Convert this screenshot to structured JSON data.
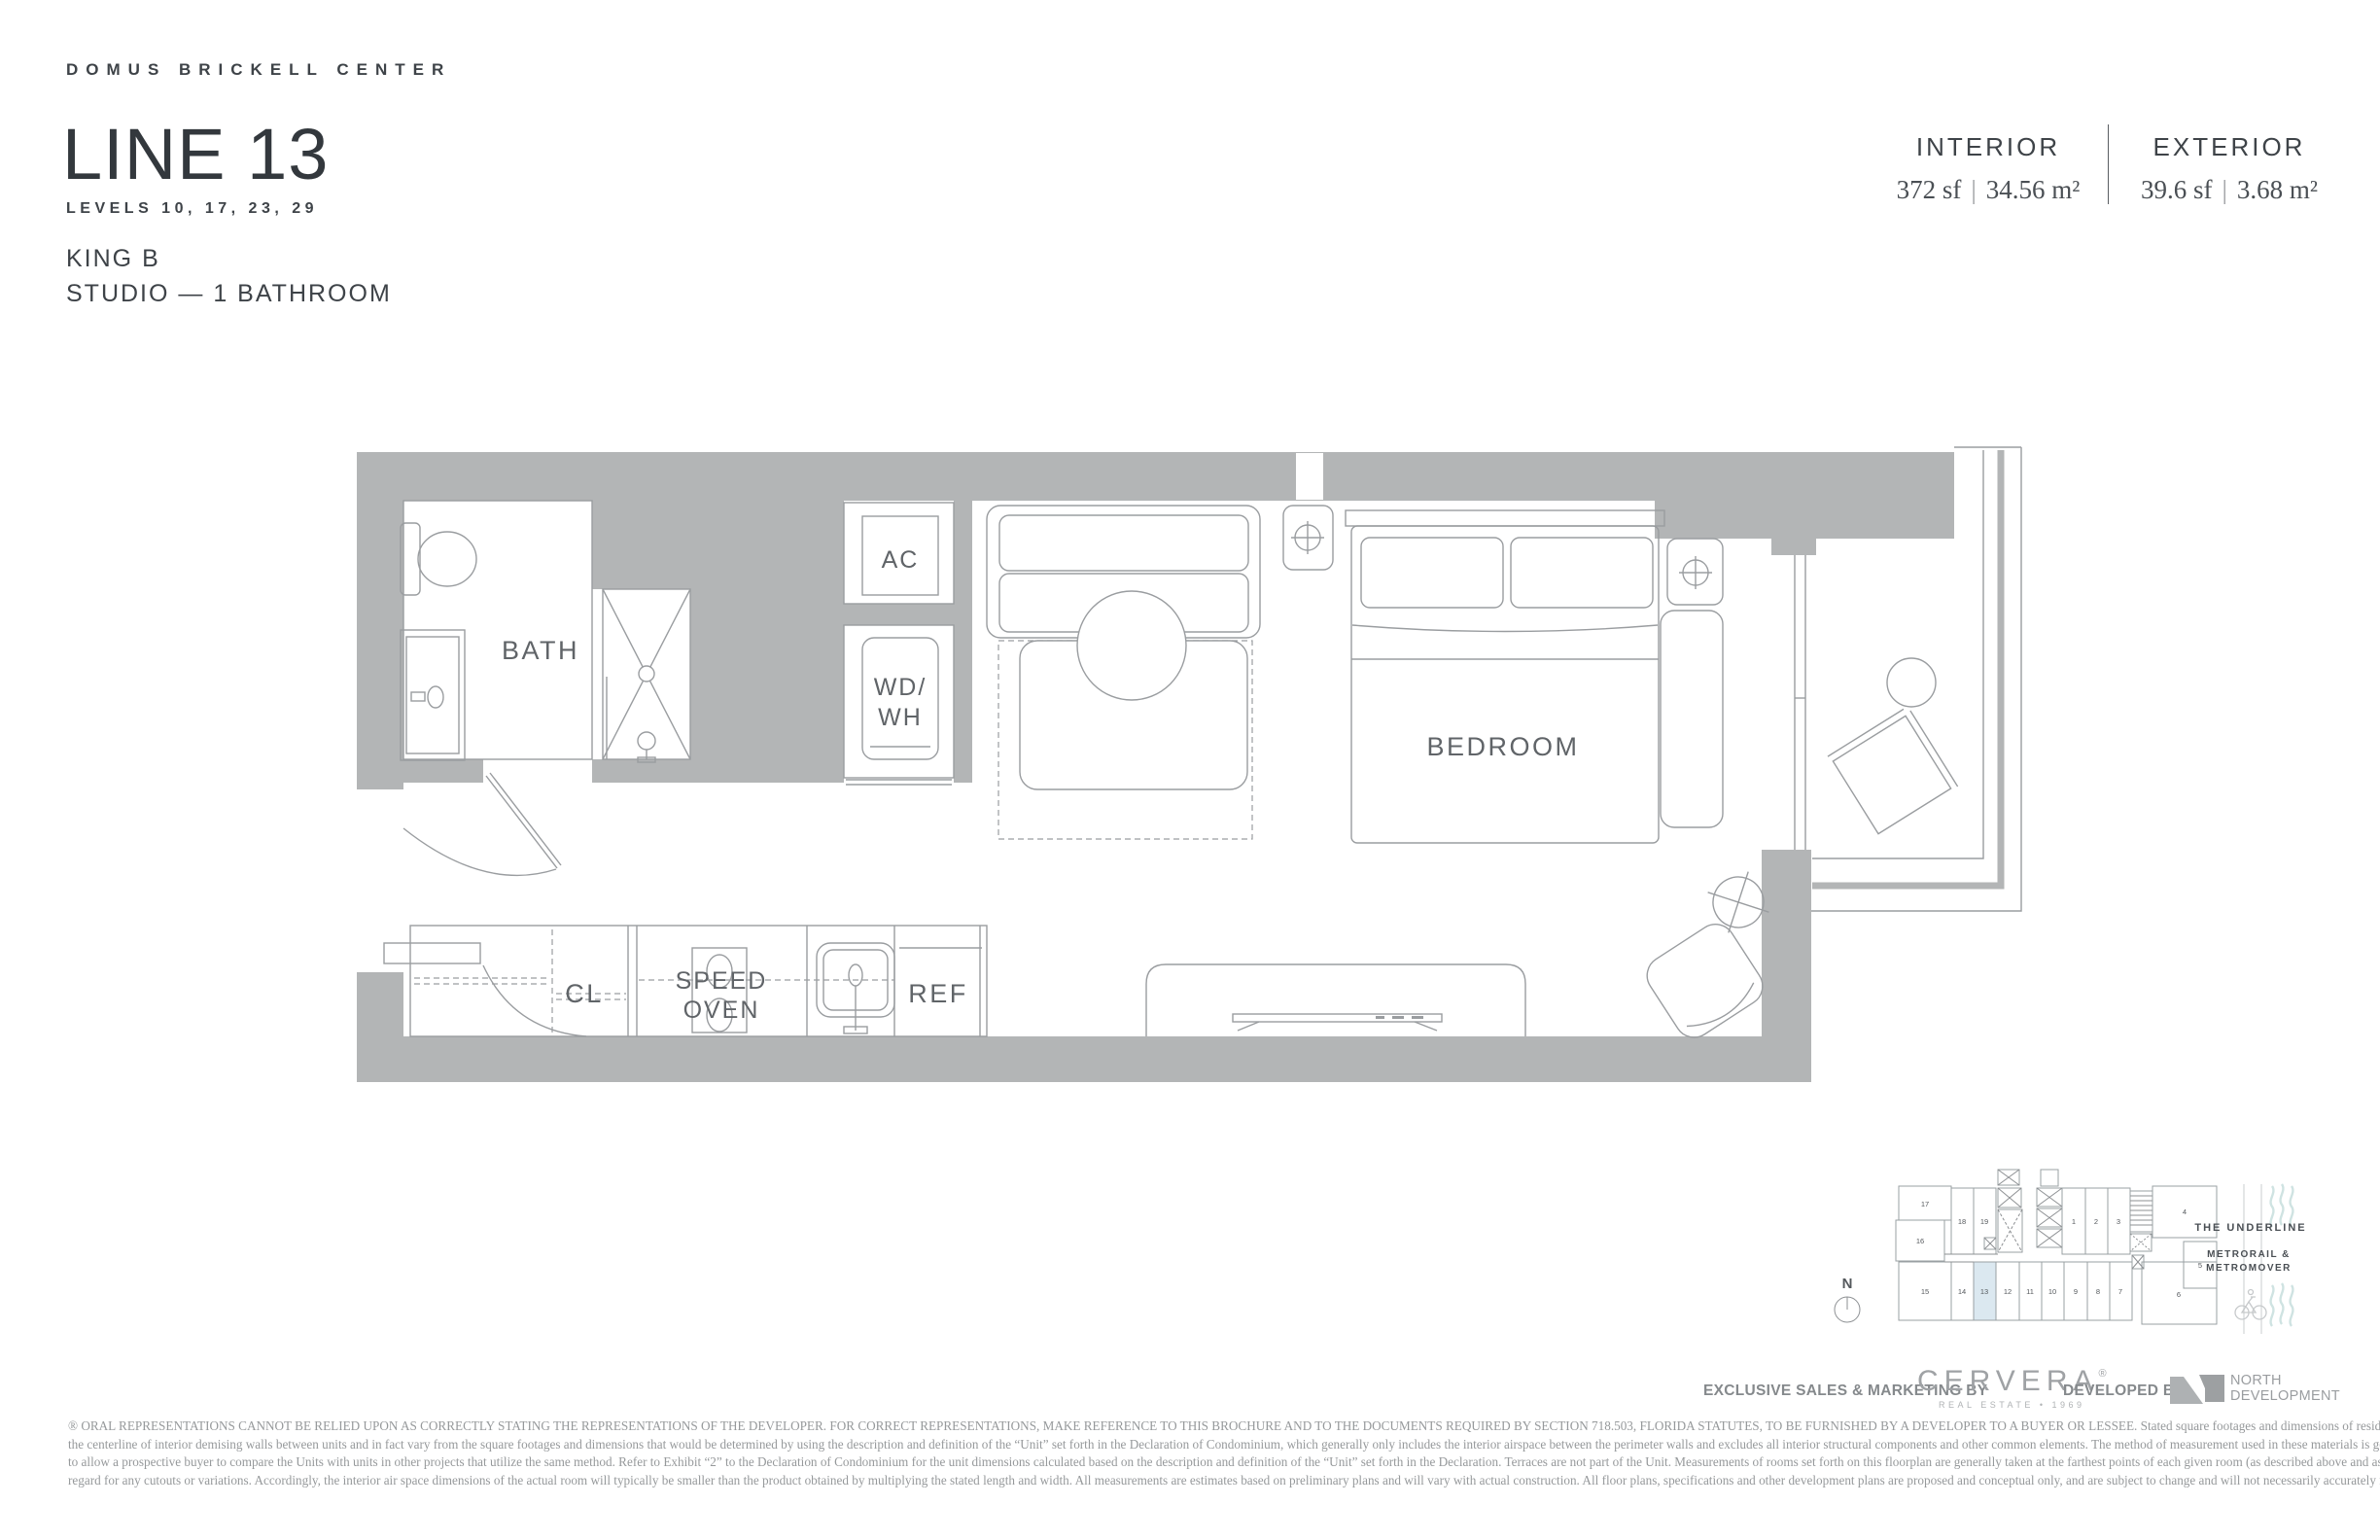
{
  "header": {
    "brand": "DOMUS BRICKELL CENTER",
    "title": "LINE 13",
    "levels": "LEVELS 10, 17, 23, 29",
    "unit_type": "KING B",
    "layout": "STUDIO — 1 BATHROOM"
  },
  "stats": {
    "interior": {
      "label": "INTERIOR",
      "sf": "372 sf",
      "m2": "34.56 m²"
    },
    "exterior": {
      "label": "EXTERIOR",
      "sf": "39.6 sf",
      "m2": "3.68 m²"
    },
    "separator": "|"
  },
  "floorplan": {
    "labels": {
      "bath": "BATH",
      "ac": "AC",
      "wd_line1": "WD/",
      "wd_line2": "WH",
      "bedroom": "BEDROOM",
      "cl": "CL",
      "speed_line1": "SPEED",
      "speed_line2": "OVEN",
      "ref": "REF"
    }
  },
  "keyplan": {
    "north": "N",
    "u1": "1",
    "u2": "2",
    "u3": "3",
    "u4": "4",
    "u5": "5",
    "u6": "6",
    "u7": "7",
    "u8": "8",
    "u9": "9",
    "u10": "10",
    "u11": "11",
    "u12": "12",
    "u13": "13",
    "u14": "14",
    "u15": "15",
    "u16": "16",
    "u17": "17",
    "u18": "18",
    "u19": "19",
    "highlighted_unit": "13",
    "highlight_color": "#dbe8f0",
    "underline_label": "THE UNDERLINE",
    "metrorail_line1": "METRORAIL &",
    "metrorail_line2": "METROMOVER"
  },
  "footer": {
    "sales_label": "EXCLUSIVE SALES & MARKETING BY",
    "cervera_name": "CERVERA",
    "cervera_reg": "®",
    "cervera_sub": "REAL ESTATE • 1969",
    "developed_label": "DEVELOPED BY",
    "developer_line1": "NORTH",
    "developer_line2": "DEVELOPMENT"
  },
  "disclaimer": {
    "line1": "® ORAL REPRESENTATIONS CANNOT BE RELIED UPON AS CORRECTLY STATING THE REPRESENTATIONS OF THE DEVELOPER. FOR CORRECT REPRESENTATIONS, MAKE REFERENCE TO THIS BROCHURE AND TO THE DOCUMENTS REQUIRED BY SECTION 718.503, FLORIDA STATUTES, TO BE FURNISHED BY A DEVELOPER TO A BUYER OR LESSEE. Stated square footages and dimensions of residences are measured to the exterior boundaries of the exterior walls and",
    "line2": "the centerline of interior demising walls between units and in fact vary from the square footages and dimensions that would be determined by using the description and definition of the “Unit” set forth in the Declaration of Condominium, which generally only includes the interior airspace between the perimeter walls and excludes all interior structural components and other common elements.  The method of measurement used in these materials is generally used in sales materials and is provided",
    "line3": "to allow a prospective buyer to compare the Units with units in other projects that utilize the same method. Refer to Exhibit “2” to the Declaration of Condominium for the unit dimensions calculated based on the description and definition of the “Unit” set forth in the Declaration. Terraces are not part of the Unit.  Measurements of rooms set forth on this floorplan are generally taken at the farthest points of each given room (as described above and as if the room were a perfect rectangle), without",
    "line4": "regard for any cutouts or variations.  Accordingly, the interior air space dimensions of the actual room will typically be smaller than the product obtained by multiplying the stated length and width.  All measurements are estimates based on preliminary plans and will vary with actual construction. All floor plans, specifications and other development plans are proposed and conceptual only, and are subject to change and will not necessarily accurately reflect the final plans and specifications."
  },
  "colors": {
    "wall": "#b3b5b6",
    "line": "#9a9da0",
    "text_dark": "#3e4348",
    "text_light": "#96999b",
    "teal": "#cfe3e2",
    "highlight": "#dbe8f0"
  }
}
